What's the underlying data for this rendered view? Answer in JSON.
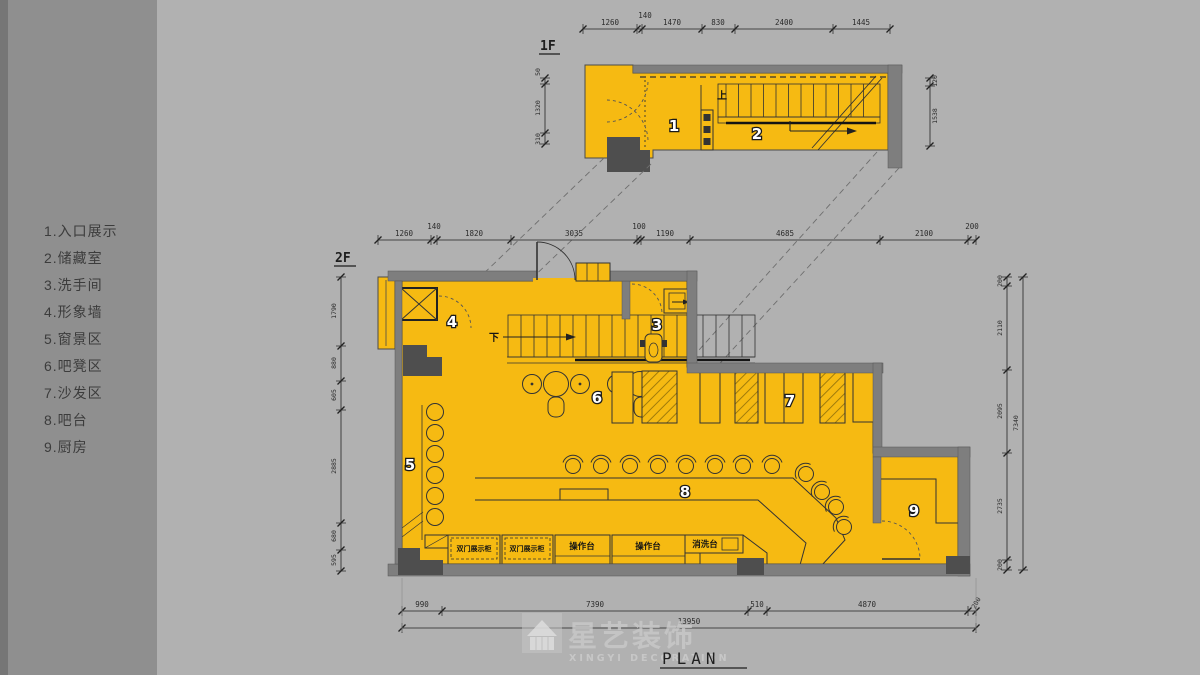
{
  "legend": {
    "items": [
      "1.入口展示",
      "2.储藏室",
      "3.洗手间",
      "4.形象墙",
      "5.窗景区",
      "6.吧凳区",
      "7.沙发区",
      "8.吧台",
      "9.厨房"
    ]
  },
  "plans": {
    "f1_label": "1F",
    "f2_label": "2F",
    "plan_title": "PLAN",
    "stair_up": "上",
    "stair_down": "下",
    "rooms": [
      "1",
      "2",
      "3",
      "4",
      "5",
      "6",
      "7",
      "8",
      "9"
    ]
  },
  "counters": {
    "list": [
      "双门展示柜",
      "双门展示柜",
      "操作台",
      "操作台",
      "消洗台"
    ]
  },
  "dims": {
    "f1_top": [
      "1260",
      "140",
      "1470",
      "830",
      "2400",
      "1445"
    ],
    "f1_left": [
      "50",
      "1320",
      "310"
    ],
    "f1_right": [
      "120",
      "1538"
    ],
    "f2_top": [
      "1260",
      "140",
      "1820",
      "3035",
      "100",
      "1190",
      "4685",
      "2100",
      "200"
    ],
    "f2_left": [
      "1790",
      "880",
      "605",
      "2885",
      "680",
      "595"
    ],
    "f2_right": [
      "200",
      "2110",
      "2095",
      "2735",
      "200"
    ],
    "f2_right_total": "7340",
    "bottom": [
      "990",
      "7390",
      "510",
      "4870",
      "200"
    ],
    "bottom_total": "13950"
  },
  "logo": {
    "cn": "星艺装饰",
    "en": "XINGYI DECORATION"
  },
  "colors": {
    "background": "#B1B1B1",
    "sidebar": "#8F8F8F",
    "floor": "#F6BA12",
    "wall": "#7E7E7E",
    "column": "#4E4E4E",
    "line": "#333333"
  }
}
